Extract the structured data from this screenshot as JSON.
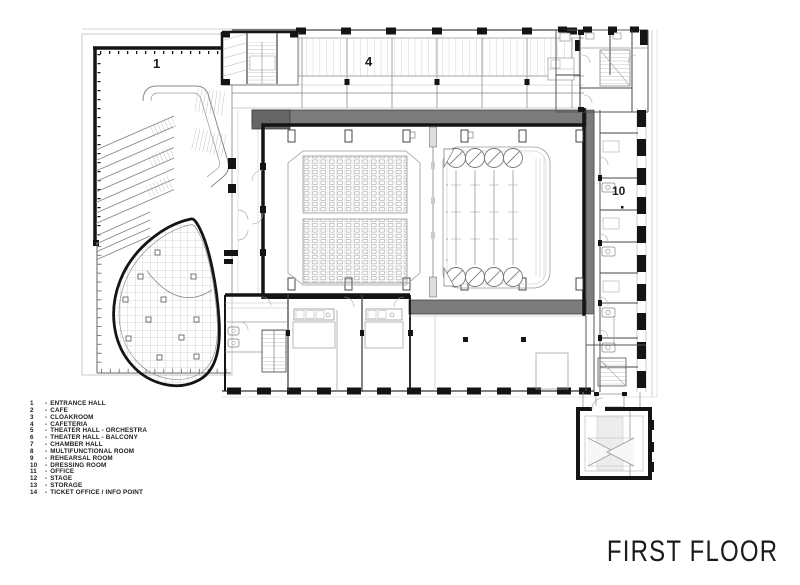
{
  "title": "FIRST FLOOR",
  "plan": {
    "labels": {
      "entrance_hall": "1",
      "cafeteria": "4",
      "dressing_room": "10"
    }
  },
  "legend": {
    "separator": "-",
    "items": [
      {
        "num": "1",
        "label": "ENTRANCE HALL"
      },
      {
        "num": "2",
        "label": "CAFE"
      },
      {
        "num": "3",
        "label": "CLOAKROOM"
      },
      {
        "num": "4",
        "label": "CAFETERIA"
      },
      {
        "num": "5",
        "label": "THEATER HALL - ORCHESTRA"
      },
      {
        "num": "6",
        "label": "THEATER HALL - BALCONY"
      },
      {
        "num": "7",
        "label": "CHAMBER HALL"
      },
      {
        "num": "8",
        "label": "MULTIFUNCTIONAL ROOM"
      },
      {
        "num": "9",
        "label": "REHEARSAL ROOM"
      },
      {
        "num": "10",
        "label": "DRESSING ROOM"
      },
      {
        "num": "11",
        "label": "OFFICE"
      },
      {
        "num": "12",
        "label": "STAGE"
      },
      {
        "num": "13",
        "label": "STORAGE"
      },
      {
        "num": "14",
        "label": "TICKET OFFICE / INFO POINT"
      }
    ]
  },
  "colors": {
    "background": "#ffffff",
    "wall_black": "#141414",
    "gallery_grey": "#7c7c7c",
    "gallery_grey_dark": "#666666",
    "detail_line_grey": "#999999"
  }
}
